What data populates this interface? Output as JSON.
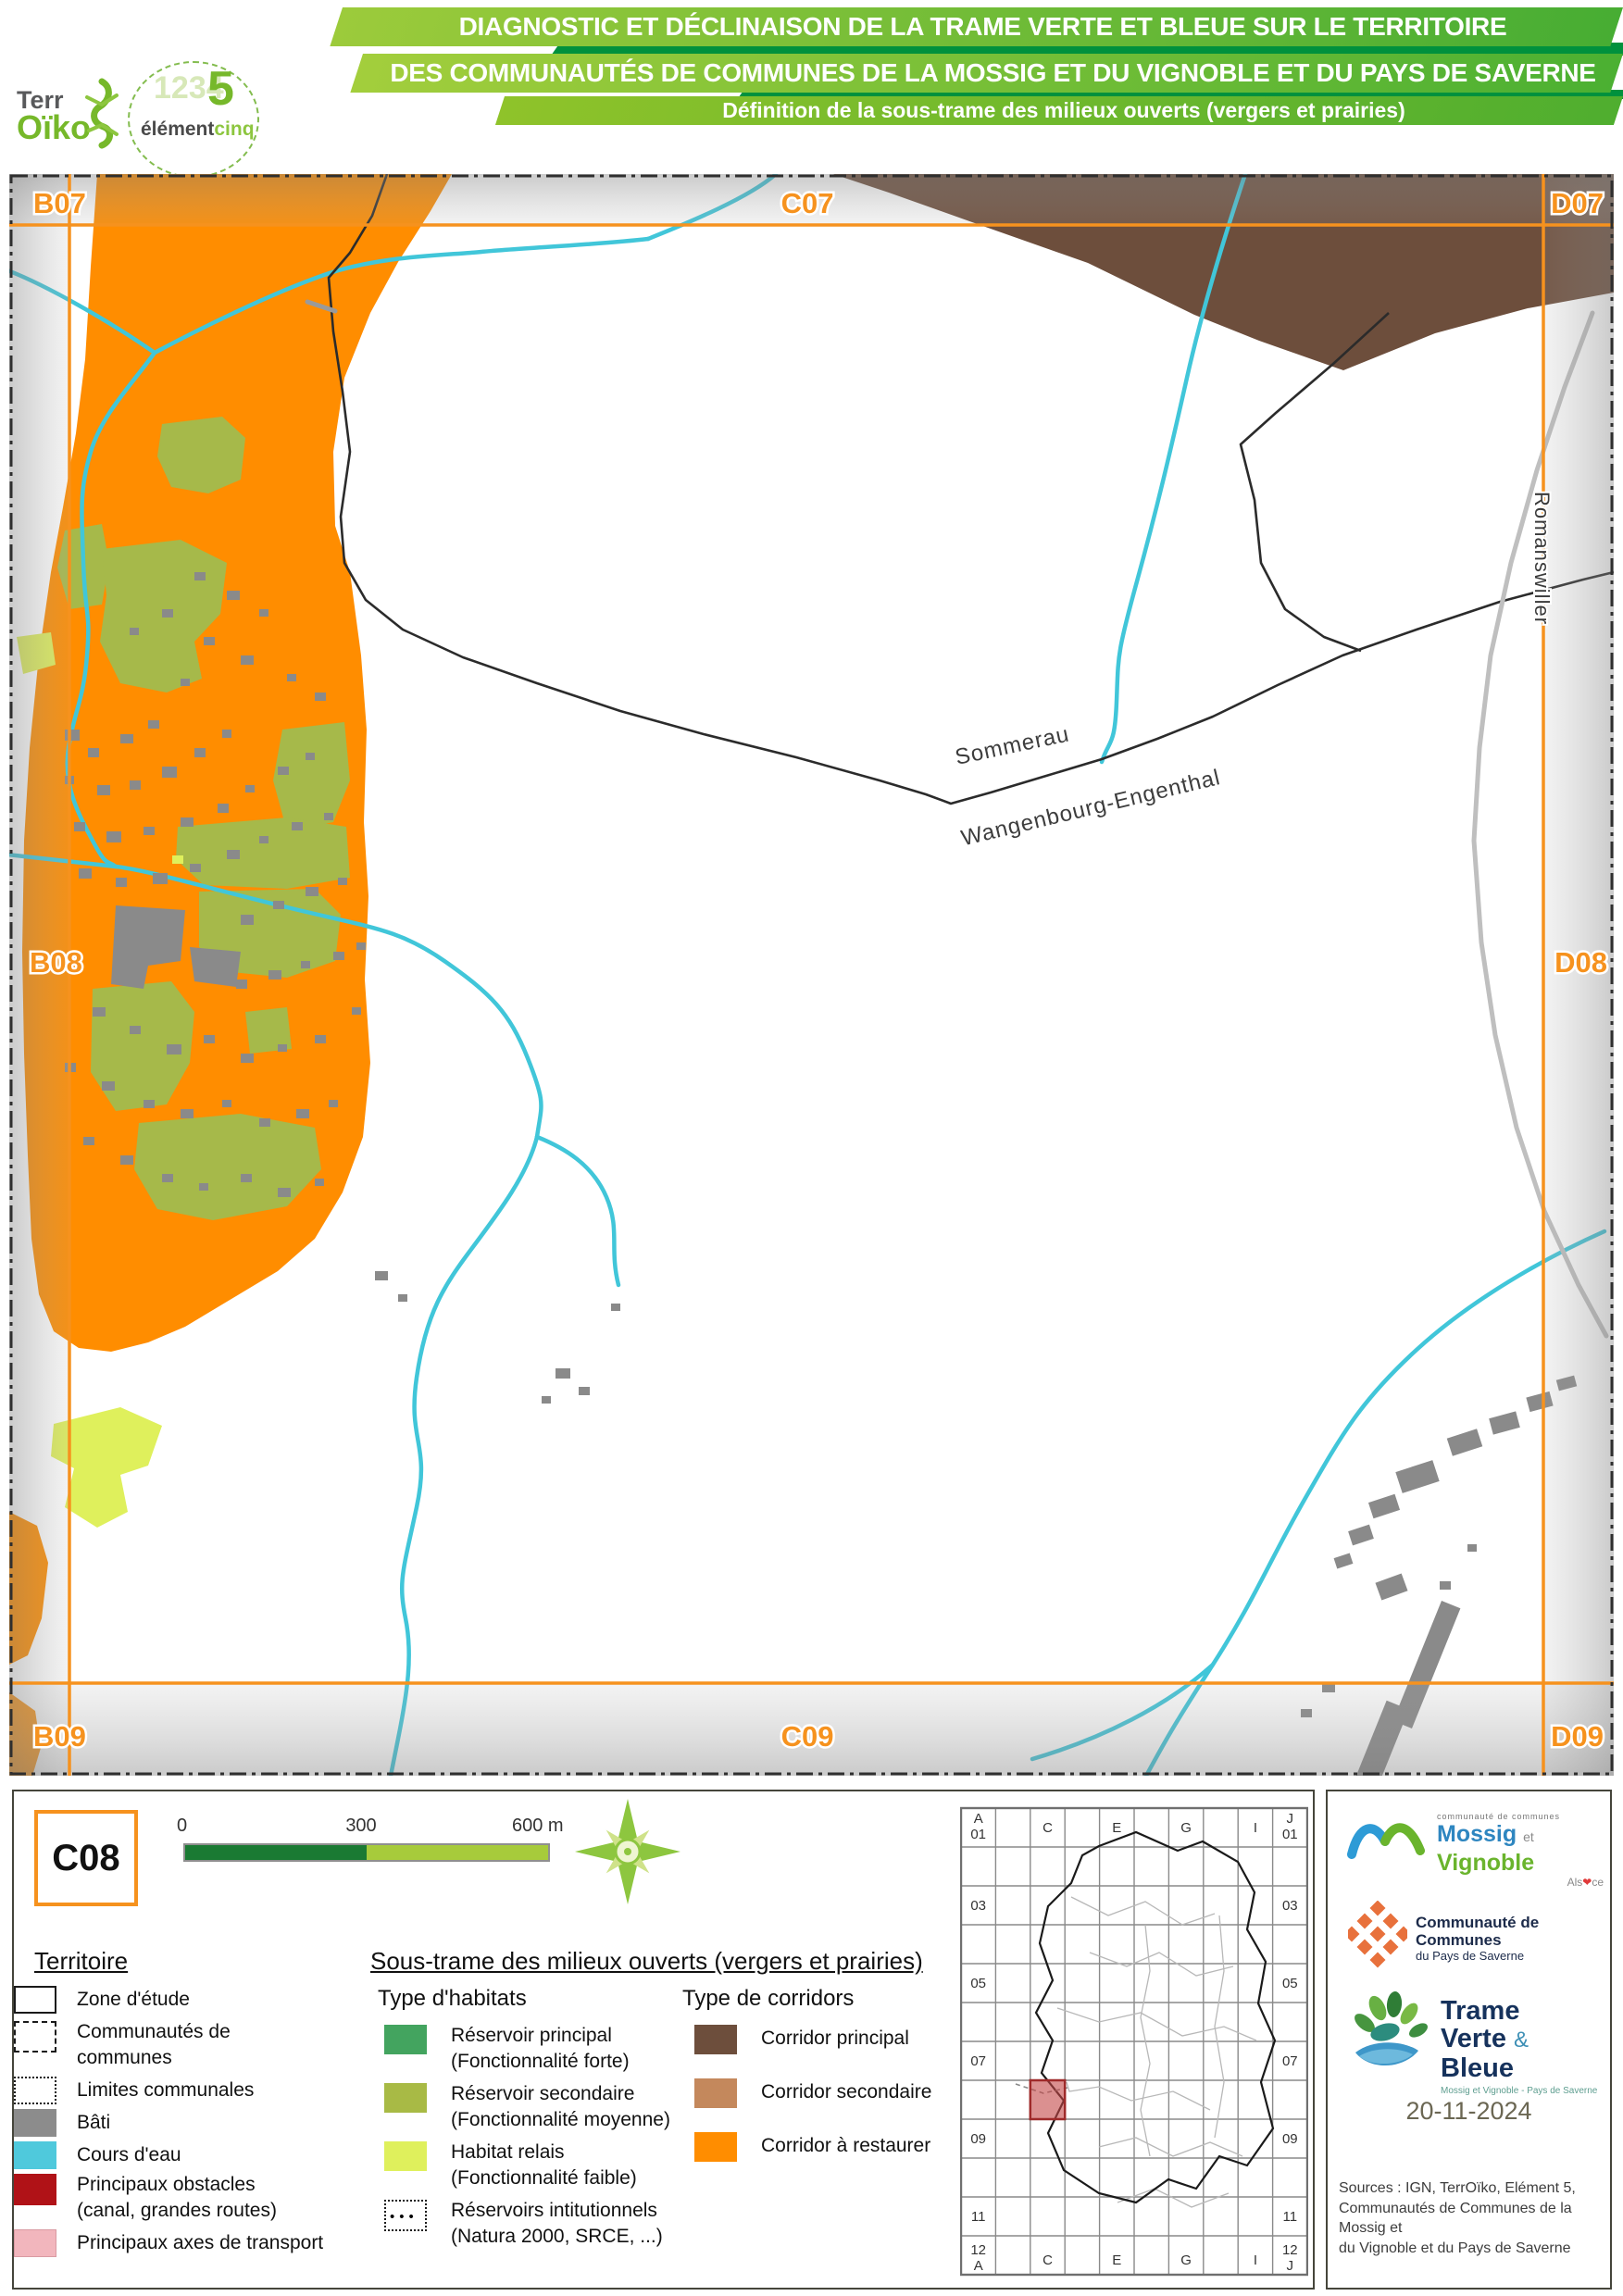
{
  "header": {
    "logo_terroiko": {
      "part1": "Terr",
      "part2": "Oïko"
    },
    "logo_elementcinq": {
      "ghost": "1234",
      "five": "5",
      "part1": "élément",
      "part2": "cinq"
    },
    "banner1": "DIAGNOSTIC ET DÉCLINAISON DE LA TRAME VERTE ET BLEUE SUR LE TERRITOIRE",
    "banner2": "DES COMMUNAUTÉS DE COMMUNES DE LA MOSSIG ET DU VIGNOBLE ET DU PAYS DE SAVERNE",
    "banner3": "Définition de la sous-trame des milieux ouverts (vergers et prairies)"
  },
  "map": {
    "grid_labels": {
      "b07": "B07",
      "c07": "C07",
      "d07": "D07",
      "b08": "B08",
      "d08": "D08",
      "b09": "B09",
      "c09": "C09",
      "d09": "D09"
    },
    "place_labels": {
      "commune1": "Sommerau",
      "commune2": "Wangenbourg-Engenthal",
      "commune3": "Romanswiller"
    },
    "colors": {
      "corridor_restaurer": "#ff8d00",
      "corridor_principal": "#6d4e3c",
      "corridor_secondaire": "#c4885c",
      "reservoir_principal": "#43a45f",
      "reservoir_secondaire": "#a6b94a",
      "habitat_relais": "#dff05c",
      "cours_eau": "#41c6d9",
      "bati": "#8a8a8a",
      "obstacles": "#b01217",
      "axes_transport": "#f2b6bd",
      "frame": "#f6921e"
    }
  },
  "legend": {
    "tile_id": "C08",
    "scalebar": {
      "t0": "0",
      "t300": "300",
      "t600": "600 m"
    },
    "territoire": {
      "title": "Territoire",
      "items": [
        {
          "label": "Zone d'étude"
        },
        {
          "label": "Communautés de",
          "label2": "communes"
        },
        {
          "label": "Limites communales"
        },
        {
          "label": "Bâti",
          "color": "#8c8c8c"
        },
        {
          "label": "Cours d'eau",
          "color": "#4fc9dc"
        },
        {
          "label": "Principaux obstacles",
          "label2": "(canal, grandes routes)",
          "color": "#b01217"
        },
        {
          "label": "Principaux axes de transport",
          "color": "#f2b6bd"
        }
      ]
    },
    "soustrame": {
      "title": "Sous-trame des milieux ouverts (vergers et prairies)",
      "habitats": {
        "title": "Type d'habitats",
        "items": [
          {
            "label": "Réservoir principal",
            "label2": "(Fonctionnalité forte)",
            "color": "#43a45f"
          },
          {
            "label": "Réservoir secondaire",
            "label2": "(Fonctionnalité moyenne)",
            "color": "#a8ba45"
          },
          {
            "label": "Habitat relais",
            "label2": "(Fonctionnalité faible)",
            "color": "#dff05c"
          },
          {
            "label": "Réservoirs intitutionnels",
            "label2": "(Natura 2000, SRCE, ...)"
          }
        ]
      },
      "corridors": {
        "title": "Type de corridors",
        "items": [
          {
            "label": "Corridor principal",
            "color": "#6d4e3c"
          },
          {
            "label": "Corridor secondaire",
            "color": "#c4885c"
          },
          {
            "label": "Corridor à restaurer",
            "color": "#ff8d00"
          }
        ]
      }
    },
    "minimap": {
      "corner_letter_a": "A",
      "corner_letter_j": "J",
      "corner_num": "01",
      "bottom_num": "12",
      "col_c": "C",
      "col_e": "E",
      "col_g": "G",
      "col_i": "I",
      "row_03": "03",
      "row_05": "05",
      "row_07": "07",
      "row_09": "09",
      "row_11": "11"
    }
  },
  "footer": {
    "mossig": {
      "top": "communauté de communes",
      "name1": "Mossig",
      "et": "et",
      "name2": "Vignoble",
      "alsace_pre": "Als",
      "alsace_post": "ce"
    },
    "saverne": {
      "line1": "Communauté de Communes",
      "line2": "du Pays de Saverne"
    },
    "tvb": {
      "word1": "Trame",
      "word2": "Verte",
      "amp": "&",
      "word3": "Bleue",
      "subtitle": "Mossig et Vignoble - Pays de Saverne"
    },
    "date": "20-11-2024",
    "sources": [
      "Sources : IGN, TerrOïko, Elément 5,",
      "Communautés de Communes de la Mossig et",
      "du Vignoble et du Pays de Saverne"
    ]
  }
}
